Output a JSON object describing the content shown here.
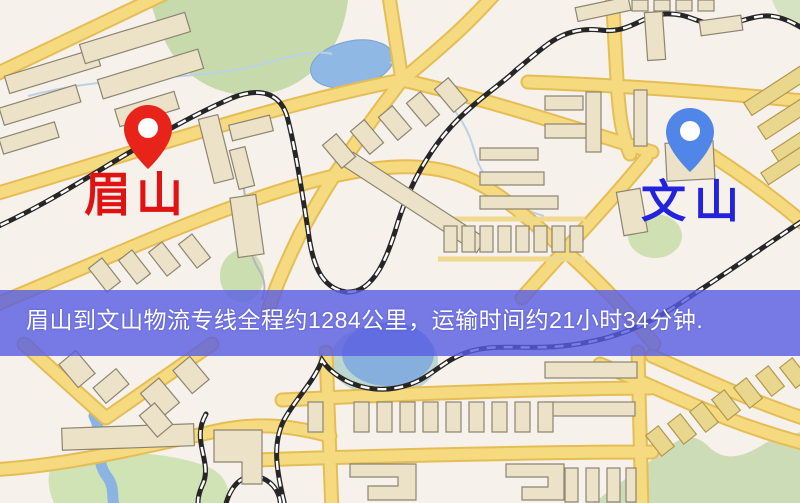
{
  "map": {
    "origin": {
      "label": "眉山",
      "pin_icon": "map-pin",
      "pin_color": "#e8231a",
      "label_color": "#e11212"
    },
    "destination": {
      "label": "文山",
      "pin_icon": "map-pin",
      "pin_color": "#4f86e8",
      "label_color": "#2323dd"
    },
    "banner": {
      "text": "眉山到文山物流专线全程约1284公里，运输时间约21小时34分钟.",
      "bg_color": "#585ce2",
      "text_color": "#ffffff"
    },
    "legend_colors": {
      "map_background": "#f6f1ea",
      "road_fill": "#f6da80",
      "road_casing": "#e5bd55",
      "building_fill": "#ebe2c8",
      "building_stroke": "#8d8472",
      "railway": "#262626",
      "water": "#8cb4e2",
      "greenery": "#cadcae"
    }
  }
}
